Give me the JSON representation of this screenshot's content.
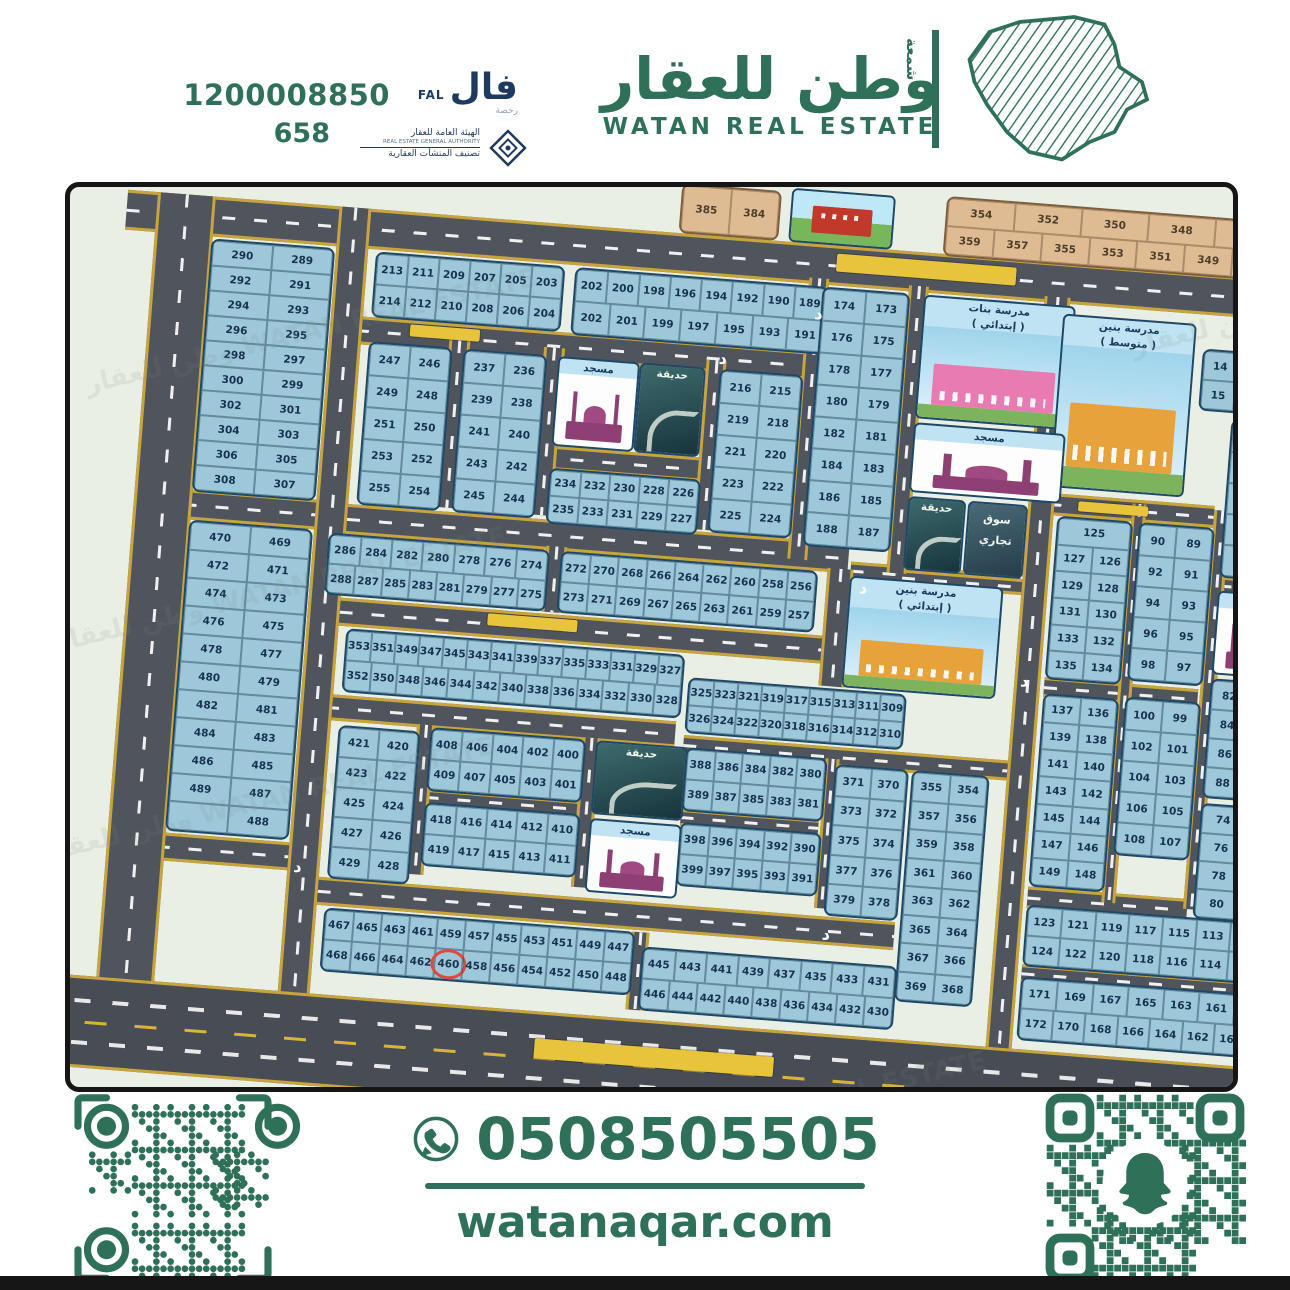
{
  "header": {
    "phone": "1200008850",
    "license_number": "658",
    "fal": {
      "ar": "فال",
      "en": "FAL",
      "sub": "رخصة"
    },
    "authority": {
      "line_ar1": "الهيئة العامة للعقار",
      "line_en": "REAL ESTATE GENERAL AUTHORITY",
      "line_ar2": "تصنيف المنشآت العقارية"
    },
    "brand": {
      "ar": "وطن للعقار",
      "en": "WATAN REAL ESTATE",
      "vertical_word": "شمعة"
    }
  },
  "footer": {
    "whatsapp_phone": "0508505505",
    "website": "watanaqar.com"
  },
  "map": {
    "street_letter": "د",
    "highlighted_plot": "460",
    "colors": {
      "plot_blue": "#9dc8d9",
      "plot_tan": "#debb93",
      "road": "#50555d",
      "road_edge": "#c8a43e",
      "brand_green": "#2e7058",
      "highlight_red": "#e0483f"
    },
    "watermark": "وطن للعقار WATAN REAL ESTATE",
    "facilities": [
      {
        "id": "girls",
        "type": "school",
        "color": "#e87cb2",
        "lines": [
          "مدرسة بنات",
          "( إبتدائي )"
        ]
      },
      {
        "id": "boysMiddle",
        "type": "school",
        "color": "#e8a23c",
        "lines": [
          "مدرسة بنين",
          "( متوسط )"
        ]
      },
      {
        "id": "boysElem",
        "type": "school",
        "color": "#e8a23c",
        "lines": [
          "مدرسة بنين",
          "( إبتدائي )"
        ]
      },
      {
        "id": "mosque1",
        "type": "mosque",
        "lines": [
          "مسجد"
        ]
      },
      {
        "id": "mosque_tl",
        "type": "mosque",
        "lines": [
          "مسجد"
        ]
      },
      {
        "id": "mosqueC",
        "type": "mosque",
        "lines": [
          "مسجد"
        ]
      },
      {
        "id": "mosque_r",
        "type": "mosque",
        "lines": [
          "مسجد"
        ]
      },
      {
        "id": "park_g",
        "type": "park",
        "lines": [
          "حديقة"
        ]
      },
      {
        "id": "park_tl",
        "type": "park",
        "lines": [
          "حديقة"
        ]
      },
      {
        "id": "parkC",
        "type": "park",
        "lines": [
          "حديقة"
        ]
      },
      {
        "id": "park_r",
        "type": "park",
        "lines": [
          "حديقة"
        ]
      },
      {
        "id": "market",
        "type": "market",
        "lines": [
          "سوق",
          "تجاري"
        ]
      },
      {
        "id": "bldg",
        "type": "building",
        "lines": []
      }
    ],
    "blocks": [
      {
        "id": "tan1",
        "type": "tan",
        "rows": [
          [
            "385",
            "384"
          ]
        ]
      },
      {
        "id": "tanA",
        "type": "tan",
        "rows": [
          [
            "354",
            "352",
            "350",
            "348",
            "346"
          ],
          [
            "359",
            "357",
            "355",
            "353",
            "351",
            "349",
            "347"
          ]
        ]
      },
      {
        "id": "tanB",
        "type": "tan",
        "rows": [
          [
            "344",
            "342",
            "340",
            "338",
            "336",
            "334",
            "332"
          ],
          [
            "345",
            "343",
            "341",
            "339",
            "337",
            "335",
            "333"
          ]
        ]
      },
      {
        "id": "L1",
        "type": "blue",
        "rows": [
          [
            "290",
            "289"
          ],
          [
            "292",
            "291"
          ],
          [
            "294",
            "293"
          ],
          [
            "296",
            "295"
          ],
          [
            "298",
            "297"
          ],
          [
            "300",
            "299"
          ],
          [
            "302",
            "301"
          ],
          [
            "304",
            "303"
          ],
          [
            "306",
            "305"
          ],
          [
            "308",
            "307"
          ]
        ]
      },
      {
        "id": "C1",
        "type": "blue",
        "rows": [
          [
            "213",
            "211",
            "209",
            "207",
            "205",
            "203"
          ],
          [
            "214",
            "212",
            "210",
            "208",
            "206",
            "204"
          ]
        ]
      },
      {
        "id": "C2",
        "type": "blue",
        "rows": [
          [
            "202",
            "200",
            "198",
            "196",
            "194",
            "192",
            "190",
            "189"
          ],
          [
            "202",
            "201",
            "199",
            "197",
            "195",
            "193",
            "191"
          ]
        ]
      },
      {
        "id": "D",
        "type": "blue",
        "rows": [
          [
            "174",
            "173"
          ],
          [
            "176",
            "175"
          ],
          [
            "178",
            "177"
          ],
          [
            "180",
            "179"
          ],
          [
            "182",
            "181"
          ],
          [
            "184",
            "183"
          ],
          [
            "186",
            "185"
          ],
          [
            "188",
            "187"
          ]
        ]
      },
      {
        "id": "E",
        "type": "blue",
        "rows": [
          [
            "247",
            "246"
          ],
          [
            "249",
            "248"
          ],
          [
            "251",
            "250"
          ],
          [
            "253",
            "252"
          ],
          [
            "255",
            "254"
          ]
        ]
      },
      {
        "id": "F",
        "type": "blue",
        "rows": [
          [
            "237",
            "236"
          ],
          [
            "239",
            "238"
          ],
          [
            "241",
            "240"
          ],
          [
            "243",
            "242"
          ],
          [
            "245",
            "244"
          ]
        ]
      },
      {
        "id": "G",
        "type": "blue",
        "rows": [
          [
            "234",
            "232",
            "230",
            "228",
            "226"
          ],
          [
            "235",
            "233",
            "231",
            "229",
            "227"
          ]
        ]
      },
      {
        "id": "H",
        "type": "blue",
        "rows": [
          [
            "216",
            "215"
          ],
          [
            "219",
            "218"
          ],
          [
            "221",
            "220"
          ],
          [
            "223",
            "222"
          ],
          [
            "225",
            "224"
          ]
        ]
      },
      {
        "id": "I",
        "type": "blue",
        "rows": [
          [
            "286",
            "284",
            "282",
            "280",
            "278",
            "276",
            "274"
          ],
          [
            "288",
            "287",
            "285",
            "283",
            "281",
            "279",
            "277",
            "275"
          ]
        ]
      },
      {
        "id": "J",
        "type": "blue",
        "rows": [
          [
            "272",
            "270",
            "268",
            "266",
            "264",
            "262",
            "260",
            "258",
            "256"
          ],
          [
            "273",
            "271",
            "269",
            "267",
            "265",
            "263",
            "261",
            "259",
            "257"
          ]
        ]
      },
      {
        "id": "K",
        "type": "blue",
        "rows": [
          [
            "125"
          ],
          [
            "127",
            "126"
          ],
          [
            "129",
            "128"
          ],
          [
            "131",
            "130"
          ],
          [
            "133",
            "132"
          ],
          [
            "135",
            "134"
          ]
        ]
      },
      {
        "id": "R1",
        "type": "blue",
        "rows": [
          [
            "90",
            "89"
          ],
          [
            "92",
            "91"
          ],
          [
            "94",
            "93"
          ],
          [
            "96",
            "95"
          ],
          [
            "98",
            "97"
          ]
        ]
      },
      {
        "id": "R64",
        "type": "blue",
        "rows": [
          [
            "64",
            "63"
          ],
          [
            "66",
            "65"
          ],
          [
            "68",
            "67"
          ],
          [
            "70",
            "69"
          ],
          [
            "72",
            "71"
          ]
        ]
      },
      {
        "id": "rightTop",
        "type": "blue",
        "rows": [
          [
            "14",
            "12",
            "10"
          ],
          [
            "15",
            "13",
            "11"
          ]
        ]
      },
      {
        "id": "M",
        "type": "blue",
        "rows": [
          [
            "353",
            "351",
            "349",
            "347",
            "345",
            "343",
            "341",
            "339",
            "337",
            "335",
            "333",
            "331",
            "329",
            "327"
          ],
          [
            "352",
            "350",
            "348",
            "346",
            "344",
            "342",
            "340",
            "338",
            "336",
            "334",
            "332",
            "330",
            "328"
          ]
        ]
      },
      {
        "id": "N",
        "type": "blue",
        "rows": [
          [
            "325",
            "323",
            "321",
            "319",
            "317",
            "315",
            "313",
            "311",
            "309"
          ],
          [
            "326",
            "324",
            "322",
            "320",
            "318",
            "316",
            "314",
            "312",
            "310"
          ]
        ]
      },
      {
        "id": "L2",
        "type": "blue",
        "rows": [
          [
            "470",
            "469"
          ],
          [
            "472",
            "471"
          ],
          [
            "474",
            "473"
          ],
          [
            "476",
            "475"
          ],
          [
            "478",
            "477"
          ],
          [
            "480",
            "479"
          ],
          [
            "482",
            "481"
          ],
          [
            "484",
            "483"
          ],
          [
            "486",
            "485"
          ],
          [
            "489",
            "487"
          ],
          [
            "",
            "488"
          ]
        ]
      },
      {
        "id": "O",
        "type": "blue",
        "rows": [
          [
            "421",
            "420"
          ],
          [
            "423",
            "422"
          ],
          [
            "425",
            "424"
          ],
          [
            "427",
            "426"
          ],
          [
            "429",
            "428"
          ]
        ]
      },
      {
        "id": "P",
        "type": "blue",
        "rows": [
          [
            "408",
            "406",
            "404",
            "402",
            "400"
          ],
          [
            "409",
            "407",
            "405",
            "403",
            "401"
          ]
        ]
      },
      {
        "id": "Q",
        "type": "blue",
        "rows": [
          [
            "418",
            "416",
            "414",
            "412",
            "410"
          ],
          [
            "419",
            "417",
            "415",
            "413",
            "411"
          ]
        ]
      },
      {
        "id": "S",
        "type": "blue",
        "rows": [
          [
            "388",
            "386",
            "384",
            "382",
            "380"
          ],
          [
            "389",
            "387",
            "385",
            "383",
            "381"
          ]
        ]
      },
      {
        "id": "T",
        "type": "blue",
        "rows": [
          [
            "398",
            "396",
            "394",
            "392",
            "390"
          ],
          [
            "399",
            "397",
            "395",
            "393",
            "391"
          ]
        ]
      },
      {
        "id": "U",
        "type": "blue",
        "rows": [
          [
            "371",
            "370"
          ],
          [
            "373",
            "372"
          ],
          [
            "375",
            "374"
          ],
          [
            "377",
            "376"
          ],
          [
            "379",
            "378"
          ]
        ]
      },
      {
        "id": "V",
        "type": "blue",
        "rows": [
          [
            "355",
            "354"
          ],
          [
            "357",
            "356"
          ],
          [
            "359",
            "358"
          ],
          [
            "361",
            "360"
          ],
          [
            "363",
            "362"
          ],
          [
            "365",
            "364"
          ],
          [
            "367",
            "366"
          ],
          [
            "369",
            "368"
          ]
        ]
      },
      {
        "id": "W",
        "type": "blue",
        "rows": [
          [
            "137",
            "136"
          ],
          [
            "139",
            "138"
          ],
          [
            "141",
            "140"
          ],
          [
            "143",
            "142"
          ],
          [
            "145",
            "144"
          ],
          [
            "147",
            "146"
          ],
          [
            "149",
            "148"
          ]
        ]
      },
      {
        "id": "Xb",
        "type": "blue",
        "rows": [
          [
            "100",
            "99"
          ],
          [
            "102",
            "101"
          ],
          [
            "104",
            "103"
          ],
          [
            "106",
            "105"
          ],
          [
            "108",
            "107"
          ]
        ]
      },
      {
        "id": "Yb",
        "type": "blue",
        "rows": [
          [
            "82",
            "81"
          ],
          [
            "84",
            "83"
          ],
          [
            "86",
            "85"
          ],
          [
            "88",
            "87"
          ]
        ]
      },
      {
        "id": "Zb",
        "type": "blue",
        "rows": [
          [
            "74",
            "73"
          ],
          [
            "76",
            "75"
          ],
          [
            "78",
            "77"
          ],
          [
            "80",
            "79"
          ]
        ]
      },
      {
        "id": "AA",
        "type": "blue",
        "rows": [
          [
            "123",
            "121",
            "119",
            "117",
            "115",
            "113",
            "111",
            "109"
          ],
          [
            "124",
            "122",
            "120",
            "118",
            "116",
            "114",
            "112",
            "110"
          ]
        ]
      },
      {
        "id": "BB",
        "type": "blue",
        "rows": [
          [
            "467",
            "465",
            "463",
            "461",
            "459",
            "457",
            "455",
            "453",
            "451",
            "449",
            "447"
          ],
          [
            "468",
            "466",
            "464",
            "462",
            "460",
            "458",
            "456",
            "454",
            "452",
            "450",
            "448"
          ]
        ]
      },
      {
        "id": "CC",
        "type": "blue",
        "rows": [
          [
            "445",
            "443",
            "441",
            "439",
            "437",
            "435",
            "433",
            "431"
          ],
          [
            "446",
            "444",
            "442",
            "440",
            "438",
            "436",
            "434",
            "432",
            "430"
          ]
        ]
      },
      {
        "id": "DD",
        "type": "blue",
        "rows": [
          [
            "171",
            "169",
            "167",
            "165",
            "163",
            "161",
            "159",
            "157",
            "155",
            "153",
            "151"
          ],
          [
            "172",
            "170",
            "168",
            "166",
            "164",
            "162",
            "160",
            "158",
            "156",
            "154",
            "152",
            "150"
          ]
        ]
      }
    ]
  }
}
